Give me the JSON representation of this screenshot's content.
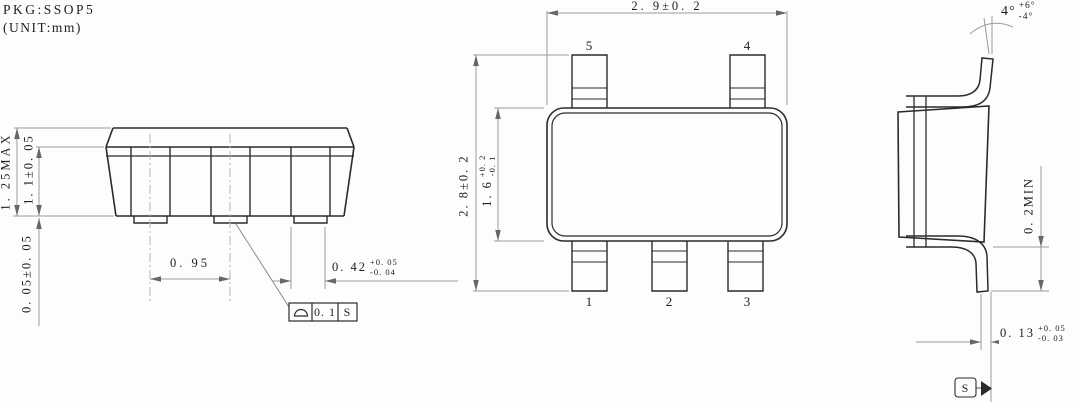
{
  "header": {
    "pkg": "PKG:SSOP5",
    "unit": "(UNIT:mm)"
  },
  "front_view": {
    "dim_total_height": "1. 25MAX",
    "dim_body_height": "1. 1±0. 05",
    "dim_standoff": "0. 05±0. 05",
    "dim_pitch": "0. 95",
    "lead_width": {
      "value": "0. 42",
      "tol_plus": "+0. 05",
      "tol_minus": "-0. 04"
    },
    "fcf": {
      "symbol": "seating-plane",
      "tolerance": "0. 1",
      "datum": "S"
    }
  },
  "top_view": {
    "dim_width": "2. 9±0. 2",
    "dim_overall": "2. 8±0. 2",
    "dim_body": {
      "value": "1. 6",
      "tol_plus": "+0. 2",
      "tol_minus": "-0. 1"
    },
    "pins": {
      "p5": "5",
      "p4": "4",
      "p1": "1",
      "p2": "2",
      "p3": "3"
    }
  },
  "side_view": {
    "angle": {
      "value": "4°",
      "tol_plus": "+6°",
      "tol_minus": "-4°"
    },
    "dim_tip": "0. 2MIN",
    "lead_thickness": {
      "value": "0. 13",
      "tol_plus": "+0. 05",
      "tol_minus": "-0. 03"
    },
    "datum": "S"
  }
}
